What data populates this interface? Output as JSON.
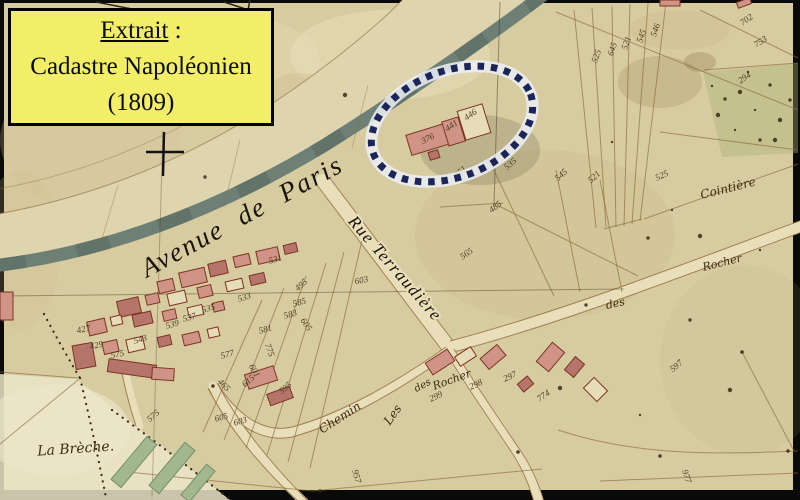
{
  "title_box": {
    "line1_underlined": "Extrait",
    "line1_rest": " :",
    "line2": "Cadastre Napoléonien",
    "line3": "(1809)"
  },
  "map_labels": {
    "avenue": "Avenue de Paris",
    "rue": "Rue Terraudière",
    "cointiere": "Cointière",
    "rocher": "Rocher",
    "des": "des",
    "chemin": "Chemin",
    "les": "Les",
    "des2": "des",
    "rochers": "Rocher",
    "la_breche": "La Brèche."
  },
  "colors": {
    "paper": "#d7cca0",
    "band": "#ded4ad",
    "stripe": "#6e8076",
    "pink": "#cf9486",
    "pink_dark": "#b5756b",
    "outline": "#7e3322",
    "yellow": "#f2ee67",
    "navy": "#1c2558",
    "halo": "#eceef4",
    "green": "#a3b78d",
    "ink": "#43331c"
  },
  "parcel_numbers": [
    {
      "t": "702",
      "x": 748,
      "y": 22,
      "r": -35
    },
    {
      "t": "753",
      "x": 762,
      "y": 44,
      "r": -32
    },
    {
      "t": "294",
      "x": 746,
      "y": 80,
      "r": -35
    },
    {
      "t": "525",
      "x": 599,
      "y": 57,
      "r": -72
    },
    {
      "t": "645",
      "x": 615,
      "y": 50,
      "r": -72
    },
    {
      "t": "521",
      "x": 629,
      "y": 44,
      "r": -72
    },
    {
      "t": "545",
      "x": 644,
      "y": 37,
      "r": -70
    },
    {
      "t": "546",
      "x": 658,
      "y": 31,
      "r": -70
    },
    {
      "t": "376",
      "x": 429,
      "y": 141,
      "r": -28
    },
    {
      "t": "441",
      "x": 453,
      "y": 128,
      "r": -35
    },
    {
      "t": "446",
      "x": 472,
      "y": 117,
      "r": -35
    },
    {
      "t": "451",
      "x": 462,
      "y": 174,
      "r": -42
    },
    {
      "t": "535",
      "x": 512,
      "y": 166,
      "r": -40
    },
    {
      "t": "545",
      "x": 563,
      "y": 177,
      "r": -42
    },
    {
      "t": "521",
      "x": 596,
      "y": 179,
      "r": -42
    },
    {
      "t": "565",
      "x": 468,
      "y": 256,
      "r": -35
    },
    {
      "t": "485",
      "x": 497,
      "y": 209,
      "r": -38
    },
    {
      "t": "525",
      "x": 663,
      "y": 178,
      "r": -25
    },
    {
      "t": "603",
      "x": 362,
      "y": 283,
      "r": -12
    },
    {
      "t": "495",
      "x": 303,
      "y": 287,
      "r": -42
    },
    {
      "t": "605",
      "x": 304,
      "y": 326,
      "r": 55
    },
    {
      "t": "775",
      "x": 267,
      "y": 351,
      "r": 70
    },
    {
      "t": "601",
      "x": 252,
      "y": 372,
      "r": 60
    },
    {
      "t": "615",
      "x": 250,
      "y": 383,
      "r": -40
    },
    {
      "t": "595",
      "x": 287,
      "y": 390,
      "r": -40
    },
    {
      "t": "465",
      "x": 222,
      "y": 387,
      "r": 45
    },
    {
      "t": "605",
      "x": 222,
      "y": 420,
      "r": -15
    },
    {
      "t": "603",
      "x": 241,
      "y": 424,
      "r": -15
    },
    {
      "t": "575",
      "x": 155,
      "y": 418,
      "r": -40
    },
    {
      "t": "299",
      "x": 437,
      "y": 399,
      "r": -25
    },
    {
      "t": "298",
      "x": 477,
      "y": 387,
      "r": -25
    },
    {
      "t": "297",
      "x": 511,
      "y": 379,
      "r": -25
    },
    {
      "t": "957",
      "x": 354,
      "y": 477,
      "r": 75
    },
    {
      "t": "977",
      "x": 684,
      "y": 477,
      "r": 72
    },
    {
      "t": "597",
      "x": 678,
      "y": 368,
      "r": -40
    },
    {
      "t": "774",
      "x": 545,
      "y": 398,
      "r": -35
    },
    {
      "t": "533",
      "x": 245,
      "y": 300,
      "r": -15,
      "s": 7
    },
    {
      "t": "535",
      "x": 209,
      "y": 311,
      "r": -15,
      "s": 7
    },
    {
      "t": "539",
      "x": 173,
      "y": 327,
      "r": -15,
      "s": 7
    },
    {
      "t": "543",
      "x": 141,
      "y": 342,
      "r": -15,
      "s": 7
    },
    {
      "t": "575",
      "x": 118,
      "y": 357,
      "r": -12,
      "s": 7
    },
    {
      "t": "577",
      "x": 228,
      "y": 357,
      "r": -15,
      "s": 7
    },
    {
      "t": "581",
      "x": 266,
      "y": 332,
      "r": -15,
      "s": 7
    },
    {
      "t": "583",
      "x": 291,
      "y": 317,
      "r": -15,
      "s": 7
    },
    {
      "t": "429",
      "x": 97,
      "y": 348,
      "r": -12,
      "s": 7
    },
    {
      "t": "537",
      "x": 190,
      "y": 320,
      "r": -15,
      "s": 7
    },
    {
      "t": "427",
      "x": 84,
      "y": 332,
      "r": -12,
      "s": 7
    },
    {
      "t": "531",
      "x": 276,
      "y": 262,
      "r": -15,
      "s": 7
    },
    {
      "t": "585",
      "x": 300,
      "y": 305,
      "r": -15,
      "s": 7
    }
  ],
  "buildings": [
    {
      "x": 180,
      "y": 270,
      "w": 26,
      "h": 15,
      "r": -13,
      "t": "p"
    },
    {
      "x": 209,
      "y": 262,
      "w": 18,
      "h": 13,
      "r": -13,
      "t": "d"
    },
    {
      "x": 234,
      "y": 255,
      "w": 16,
      "h": 11,
      "r": -13,
      "t": "p"
    },
    {
      "x": 257,
      "y": 249,
      "w": 22,
      "h": 13,
      "r": -13,
      "t": "p"
    },
    {
      "x": 284,
      "y": 244,
      "w": 13,
      "h": 9,
      "r": -13,
      "t": "d"
    },
    {
      "x": 158,
      "y": 280,
      "w": 16,
      "h": 12,
      "r": -13,
      "t": "p"
    },
    {
      "x": 118,
      "y": 299,
      "w": 22,
      "h": 16,
      "r": -13,
      "t": "d"
    },
    {
      "x": 146,
      "y": 294,
      "w": 13,
      "h": 10,
      "r": -13,
      "t": "p"
    },
    {
      "x": 168,
      "y": 292,
      "w": 18,
      "h": 12,
      "r": -13,
      "t": "o"
    },
    {
      "x": 198,
      "y": 286,
      "w": 14,
      "h": 11,
      "r": -13,
      "t": "p"
    },
    {
      "x": 226,
      "y": 280,
      "w": 17,
      "h": 10,
      "r": -13,
      "t": "o"
    },
    {
      "x": 250,
      "y": 274,
      "w": 15,
      "h": 10,
      "r": -13,
      "t": "d"
    },
    {
      "x": 88,
      "y": 320,
      "w": 18,
      "h": 14,
      "r": -13,
      "t": "p"
    },
    {
      "x": 111,
      "y": 316,
      "w": 11,
      "h": 9,
      "r": -13,
      "t": "o"
    },
    {
      "x": 133,
      "y": 313,
      "w": 19,
      "h": 12,
      "r": -13,
      "t": "d"
    },
    {
      "x": 163,
      "y": 310,
      "w": 13,
      "h": 10,
      "r": -13,
      "t": "p"
    },
    {
      "x": 188,
      "y": 306,
      "w": 15,
      "h": 10,
      "r": -13,
      "t": "o"
    },
    {
      "x": 213,
      "y": 302,
      "w": 11,
      "h": 9,
      "r": -13,
      "t": "p"
    },
    {
      "x": 74,
      "y": 344,
      "w": 20,
      "h": 24,
      "r": -10,
      "t": "d"
    },
    {
      "x": 103,
      "y": 341,
      "w": 15,
      "h": 12,
      "r": -13,
      "t": "p"
    },
    {
      "x": 127,
      "y": 338,
      "w": 17,
      "h": 13,
      "r": -13,
      "t": "o"
    },
    {
      "x": 158,
      "y": 336,
      "w": 13,
      "h": 10,
      "r": -13,
      "t": "d"
    },
    {
      "x": 183,
      "y": 333,
      "w": 17,
      "h": 11,
      "r": -13,
      "t": "p"
    },
    {
      "x": 208,
      "y": 328,
      "w": 11,
      "h": 9,
      "r": -13,
      "t": "o"
    },
    {
      "x": 108,
      "y": 362,
      "w": 48,
      "h": 13,
      "r": 8,
      "t": "d"
    },
    {
      "x": 152,
      "y": 368,
      "w": 22,
      "h": 12,
      "r": 4,
      "t": "p"
    },
    {
      "x": 246,
      "y": 370,
      "w": 30,
      "h": 15,
      "r": -18,
      "t": "p"
    },
    {
      "x": 268,
      "y": 390,
      "w": 24,
      "h": 12,
      "r": -20,
      "t": "d"
    },
    {
      "x": 0,
      "y": 292,
      "w": 13,
      "h": 28,
      "r": 0,
      "t": "p"
    },
    {
      "x": 408,
      "y": 129,
      "w": 40,
      "h": 21,
      "r": -17,
      "t": "p"
    },
    {
      "x": 445,
      "y": 119,
      "w": 17,
      "h": 25,
      "r": -17,
      "t": "p"
    },
    {
      "x": 461,
      "y": 107,
      "w": 26,
      "h": 30,
      "r": -17,
      "t": "o"
    },
    {
      "x": 429,
      "y": 151,
      "w": 10,
      "h": 8,
      "r": -17,
      "t": "d"
    },
    {
      "x": 427,
      "y": 355,
      "w": 26,
      "h": 14,
      "r": -33,
      "t": "p"
    },
    {
      "x": 456,
      "y": 351,
      "w": 19,
      "h": 11,
      "r": -33,
      "t": "o"
    },
    {
      "x": 482,
      "y": 350,
      "w": 22,
      "h": 14,
      "r": -40,
      "t": "p"
    },
    {
      "x": 538,
      "y": 349,
      "w": 25,
      "h": 16,
      "r": -50,
      "t": "p"
    },
    {
      "x": 566,
      "y": 361,
      "w": 17,
      "h": 12,
      "r": -50,
      "t": "d"
    },
    {
      "x": 588,
      "y": 380,
      "w": 15,
      "h": 19,
      "r": -45,
      "t": "o"
    },
    {
      "x": 519,
      "y": 379,
      "w": 13,
      "h": 10,
      "r": -40,
      "t": "d"
    },
    {
      "x": 737,
      "y": 0,
      "w": 14,
      "h": 6,
      "r": -20,
      "t": "p"
    },
    {
      "x": 660,
      "y": 0,
      "w": 20,
      "h": 6,
      "r": 0,
      "t": "p"
    }
  ]
}
